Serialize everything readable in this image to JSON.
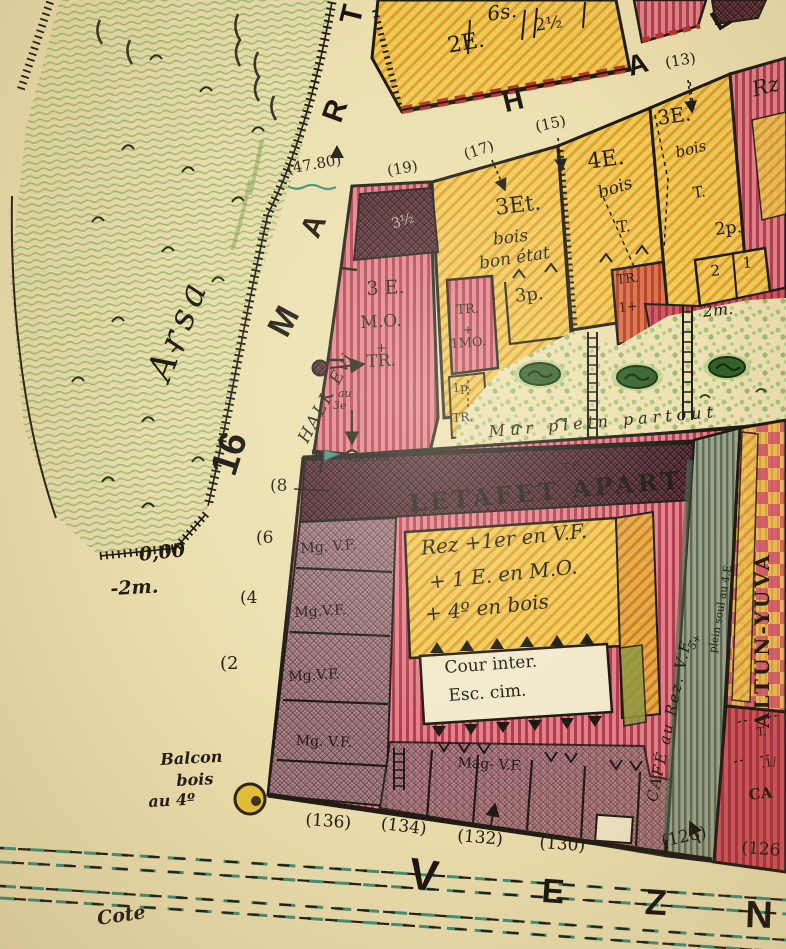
{
  "streets": {
    "mart": {
      "prefix": "16",
      "letters": [
        "M",
        "A",
        "R",
        "T"
      ]
    },
    "hal": {
      "letters": [
        "H",
        "A",
        "L"
      ]
    },
    "vezn": {
      "letters": [
        "V",
        "E",
        "Z",
        "N"
      ]
    },
    "cote": "Cote"
  },
  "vacant_lot": {
    "label": "Arsa",
    "elev_top": "0,00",
    "elev_bottom": "-2m."
  },
  "benchmark": {
    "value": "(47.80)"
  },
  "halk_evi": "HALK Evi",
  "house_numbers": {
    "hal_side": [
      "(19)",
      "(17)",
      "(15)",
      "(13)"
    ],
    "mart_side": [
      "(8",
      "(6",
      "(4",
      "(2"
    ],
    "vezn_side": [
      "(136)",
      "(134)",
      "(132)",
      "(130)",
      "(128)",
      "(126"
    ]
  },
  "buildings": {
    "top_block": {
      "a": "6s.",
      "b": "2E.",
      "c": "2½"
    },
    "halkevi_building": {
      "roof": "3½",
      "l1": "3 E.",
      "l2": "M.O.",
      "l3": "+",
      "l4": "TR.",
      "note1": "au",
      "note2": "3e"
    },
    "b17": {
      "l1": "3Et.",
      "l2": "bois",
      "l3": "bon état",
      "annex": "3p."
    },
    "b15": {
      "l1": "4E.",
      "l2": "bois",
      "l3": "T."
    },
    "b13": {
      "l1": "3E.",
      "l2": "bois",
      "l3": "T.",
      "annex": "2p.",
      "cell_left": "2",
      "cell_right": "1"
    },
    "rz": "Rz",
    "tr_1mo": {
      "l1": "TR.",
      "l2": "+",
      "l3": "1MO."
    },
    "p1_tr": {
      "l1": "1p.",
      "l2": "TR."
    },
    "tr_1": {
      "l1": "TR.",
      "l2": "1+"
    },
    "garden_note": "2m.",
    "wall_note": "Mur plein partout",
    "casino": "Casino",
    "letafet": {
      "tf": "T.F.",
      "title": "LETAFET APART",
      "d1": "Rez +1er en V.F.",
      "d2": "+ 1 E. en M.O.",
      "d3": "+ 4º en bois",
      "court1": "Cour inter.",
      "court2": "Esc. cim.",
      "cafe": "CAFÉ au Rez. V.F.",
      "plein": "plein soul au 4.E",
      "xnote": "5+"
    },
    "magazines": {
      "m1": "Mg. V.F.",
      "m2": "Mg.V.F.",
      "m3": "Mg.V.F.",
      "m4": "Mg. V.F.",
      "m5": "Mag- V.F."
    },
    "altun": "ALTUN-YUVA",
    "corner": {
      "l1": "T.",
      "l2": ".1/",
      "l3": "CA"
    }
  },
  "balcony": {
    "l1": "Balcon",
    "l2": "bois",
    "l3": "au 4º"
  },
  "colors": {
    "parchment": "#ecdfb0",
    "wood_yellow": "#f0cb55",
    "masonry_red": "#c44f5e",
    "garden_green": "#a3bd72",
    "line_teal": "#3f8f7a",
    "ink": "#1d1a14"
  }
}
